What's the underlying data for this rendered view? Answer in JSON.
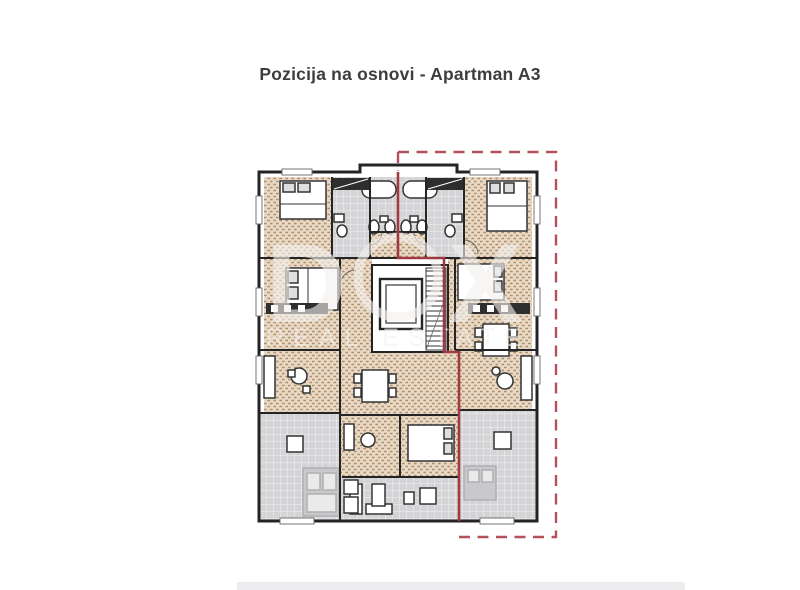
{
  "page": {
    "title": "Pozicija na osnovi - Apartman A3"
  },
  "watermark": {
    "letter_d": "D",
    "letter_x": "X",
    "subtitle": "REAL ESTATE"
  },
  "colors": {
    "title_text": "#3d3d3d",
    "boundary_dashed": "#b5515c",
    "boundary_solid": "#a03a42",
    "wall": "#242424",
    "floor_tan_base": "#e8d9c4",
    "floor_tan_hatch": "#b08d6d",
    "tile_gray_base": "#d4d4d6",
    "tile_grid": "#f2f2f4",
    "footer_bar": "#ededef"
  }
}
